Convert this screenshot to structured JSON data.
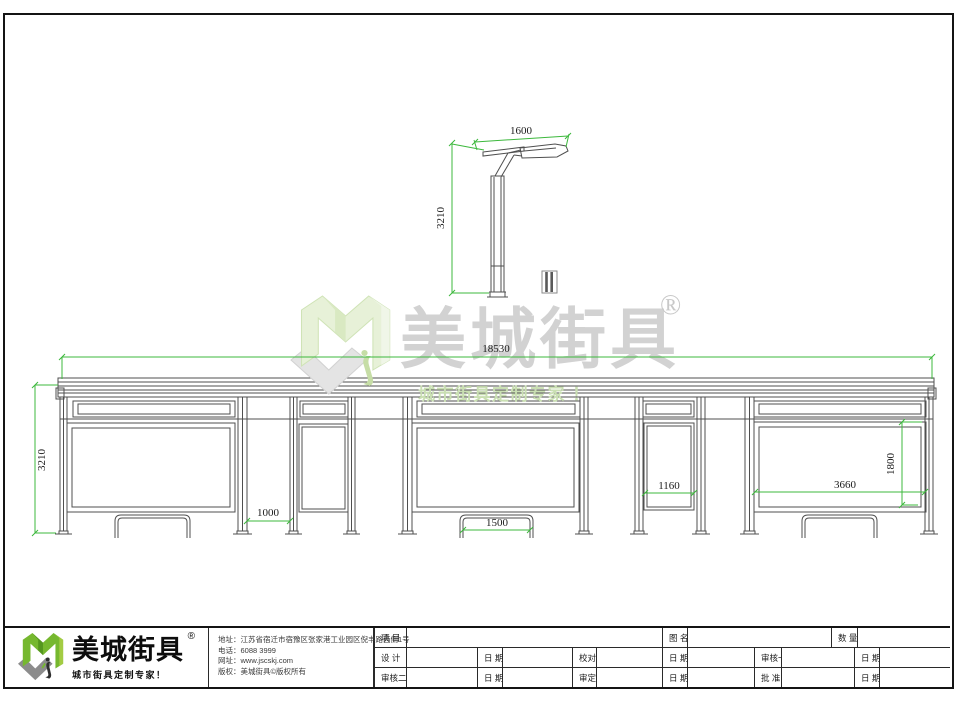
{
  "drawing": {
    "dimensions": {
      "side_top_width": "1600",
      "side_height": "3210",
      "total_length": "18530",
      "shelter_height": "3210",
      "post_gap": "1000",
      "bench_width": "1500",
      "narrow_panel_width": "1160",
      "ad_panel_width": "3660",
      "ad_panel_height": "1800"
    },
    "colors": {
      "dimension_green": "#3cb83c",
      "line_gray": "#4f4f4f"
    }
  },
  "watermark": {
    "brand": "美城街具",
    "registered": "®",
    "tagline": "城市街具定制专家 ！"
  },
  "logo": {
    "brand": "美城街具",
    "registered": "®",
    "tagline": "城市街具定制专家！"
  },
  "company": {
    "address": "地址：江苏省宿迁市宿豫区张家港工业园区倪丰路西侧1号",
    "phone": "电话：6088 3999",
    "website": "网址：www.jscskj.com",
    "copyright": "版权：美城街具©版权所有"
  },
  "title_block": {
    "project": "项 目",
    "drawing_name": "图 名",
    "quantity": "数 量",
    "design": "设 计",
    "date": "日 期",
    "proofread": "校对",
    "review1": "审核一",
    "review2": "审核二",
    "verify": "审定",
    "approve": "批 准"
  }
}
